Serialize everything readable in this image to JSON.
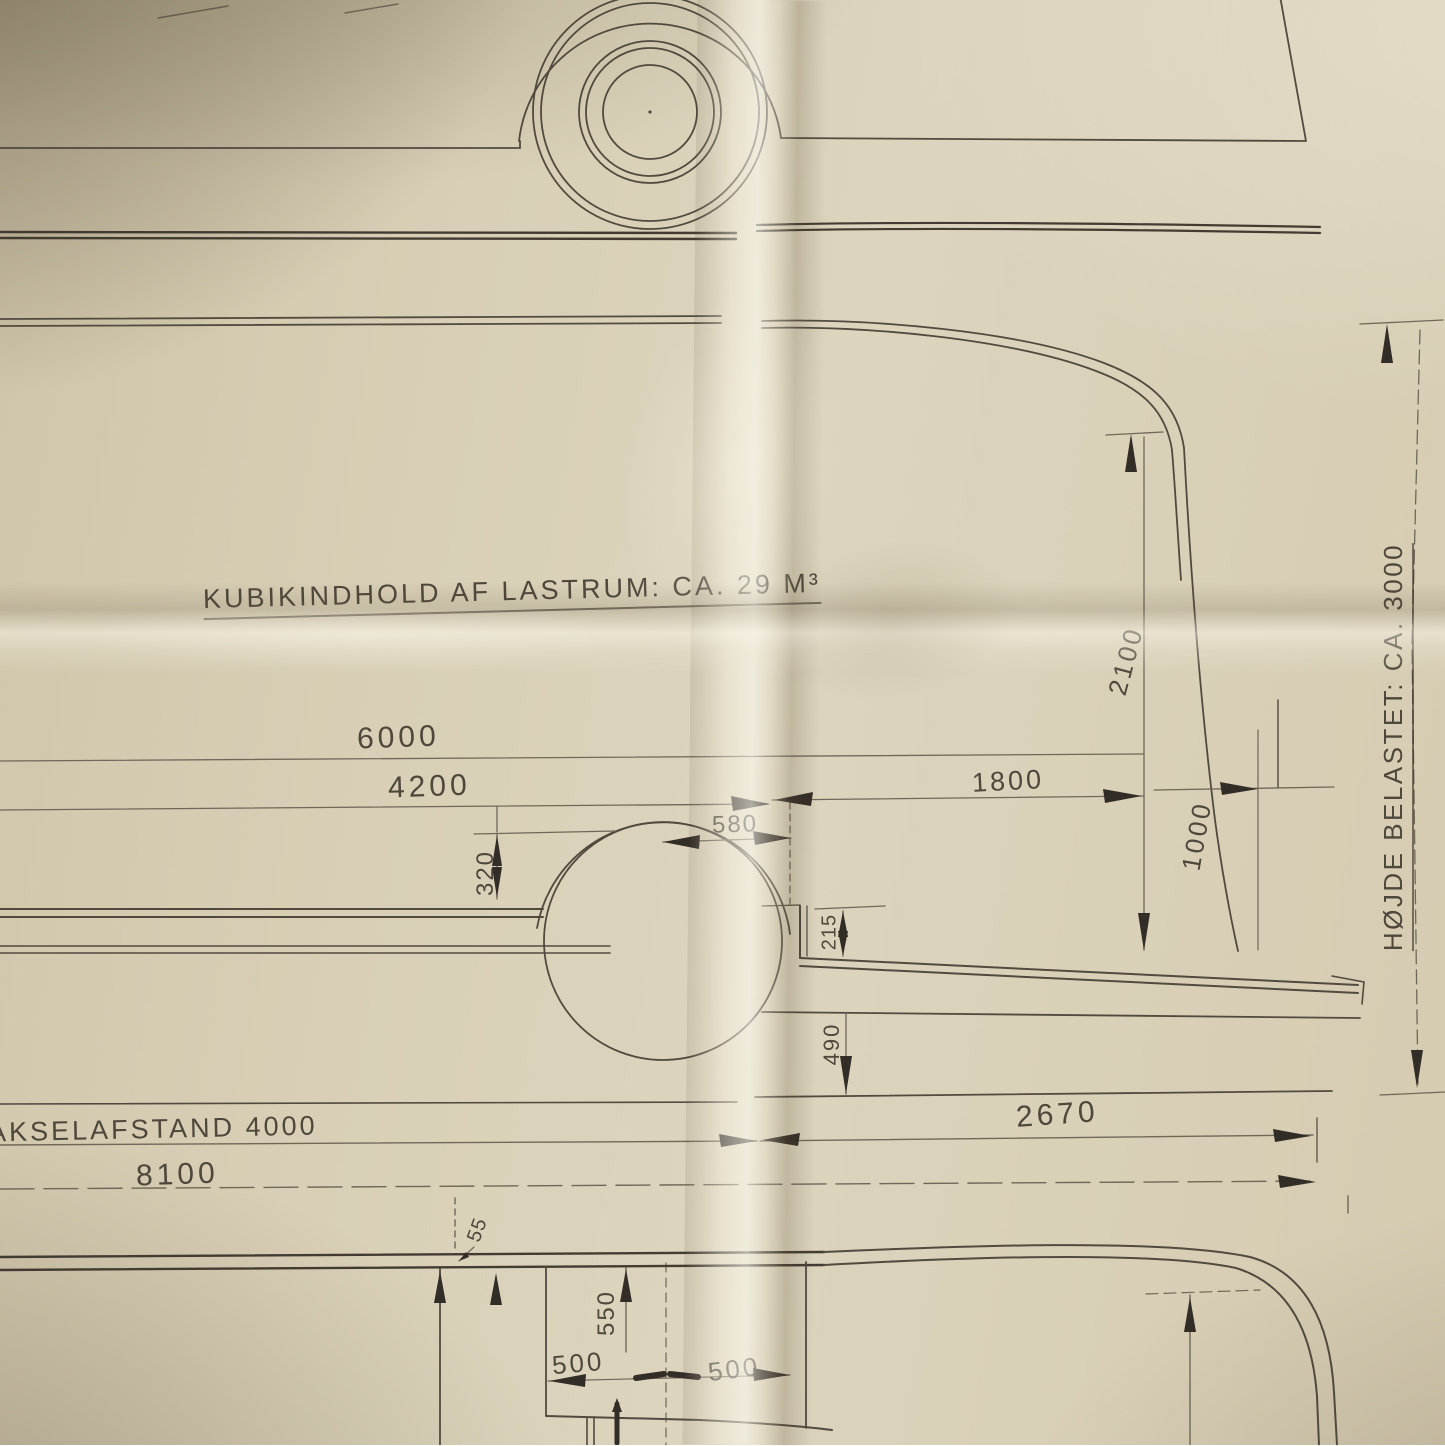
{
  "photo": {
    "colors": {
      "paper": "#d8cfb6",
      "line": "#4a4339",
      "pencil_dark": "#2a251f"
    }
  },
  "annotations": {
    "cargo_volume": "KUBIKINDHOLD AF LASTRUM: CA. 29 M³",
    "height_loaded": "HØJDE BELASTET: CA. 3000",
    "wheelbase": "AKSELAFSTAND 4000"
  },
  "dimensions": {
    "d6000": "6000",
    "d4200": "4200",
    "d1800": "1800",
    "d580": "580",
    "d320": "320",
    "d215": "215",
    "d490": "490",
    "d2100": "2100",
    "d1000": "1000",
    "d2670": "2670",
    "d8100": "8100",
    "d55": "55",
    "d550": "550",
    "d500_left": "500",
    "d500_right": "500"
  }
}
